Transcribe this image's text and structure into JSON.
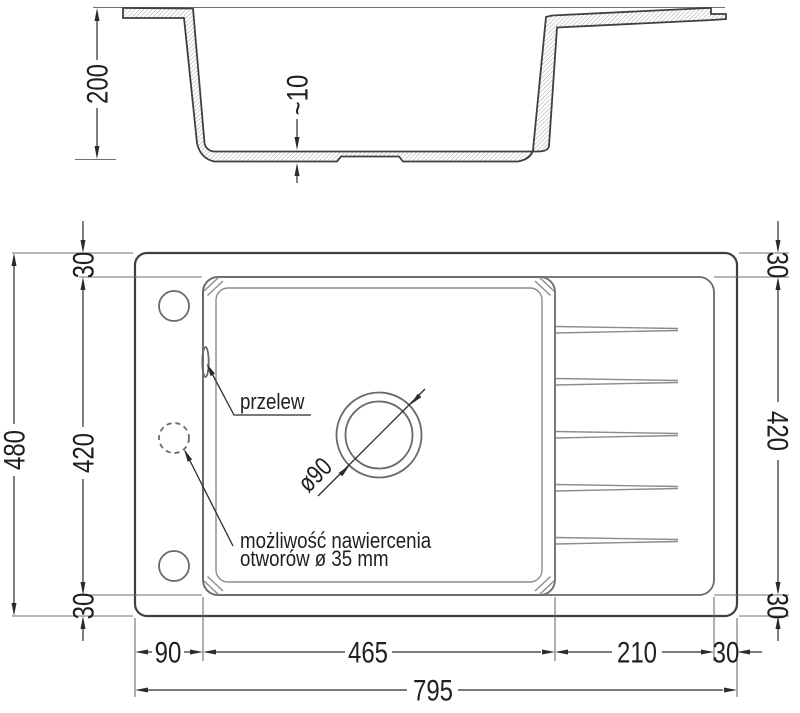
{
  "drawing": {
    "kind": "technical dimension drawing of kitchen sink with drainer",
    "background": "#ffffff",
    "line_color": "#3f3f3f",
    "dim_color": "#2b2b2b"
  },
  "section_view": {
    "depth": "200",
    "floor_thickness": "~10"
  },
  "plan_view": {
    "overall_width": "795",
    "overall_depth": "480",
    "left_rim_top": "30",
    "left_inner_depth": "420",
    "left_rim_bottom": "30",
    "right_rim_top": "30",
    "right_inner_depth": "420",
    "right_rim_bottom": "30",
    "left_margin": "90",
    "bowl_width": "465",
    "drainer_width": "210",
    "right_margin": "30",
    "drain_diameter": "ø90",
    "overflow_label": "przelew",
    "holes_note": {
      "line1": "możliwość nawiercenia",
      "line2": "otworów ø 35 mm"
    }
  }
}
